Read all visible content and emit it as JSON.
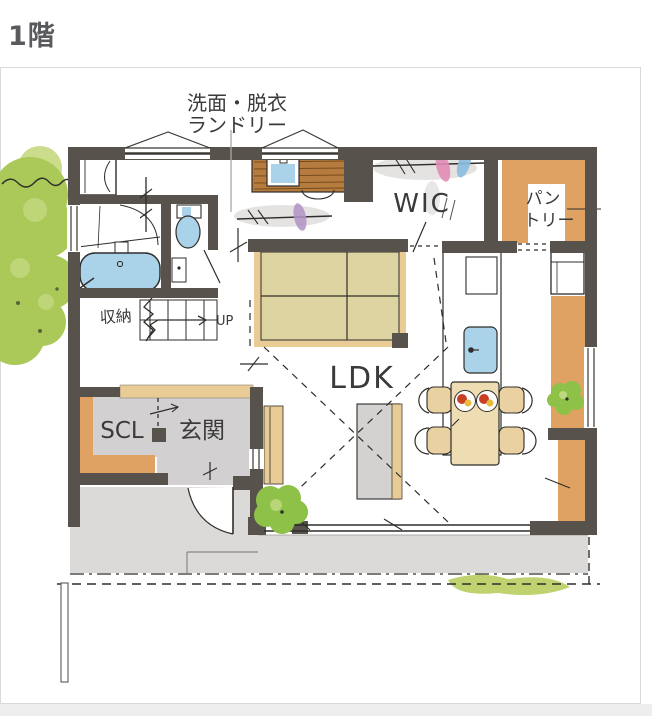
{
  "title": "1階",
  "plan": {
    "labels": {
      "laundry_line1": "洗面・脱衣",
      "laundry_line2": "ランドリー",
      "wic": "WIC",
      "pantry_line1": "パン",
      "pantry_line2": "トリー",
      "ldk": "LDK",
      "scl": "SCL",
      "entrance": "玄関",
      "storage": "収納",
      "stairs_up": "UP"
    }
  },
  "palette": {
    "wall": "#57534c",
    "ink": "#2f2d2a",
    "label_ink": "#3a3a3a",
    "title_ink": "#595a5e",
    "frame_border": "#d9d9d9",
    "shelf_orange": "#dfa263",
    "tatami": "#ddd4a2",
    "tatami_edge": "#e9cb96",
    "water": "#aad2e9",
    "floor_gray": "#d3d0d1",
    "porch_gray": "#dcdad9",
    "wood": "#b67b3e",
    "tree_green": "#aac959",
    "tree_light": "#cbdd8d",
    "bush_green": "#8ec148",
    "grass_green": "#b8cd60",
    "cloth_pink": "#e18cb5",
    "cloth_blue": "#8abbdf",
    "cloth_purple": "#b292c6",
    "table_tan": "#eedcb2",
    "chair_tan": "#e9d1a2",
    "food_red": "#c93f24",
    "food_yellow": "#e7bb3d",
    "smudge": "#b4aeab"
  }
}
